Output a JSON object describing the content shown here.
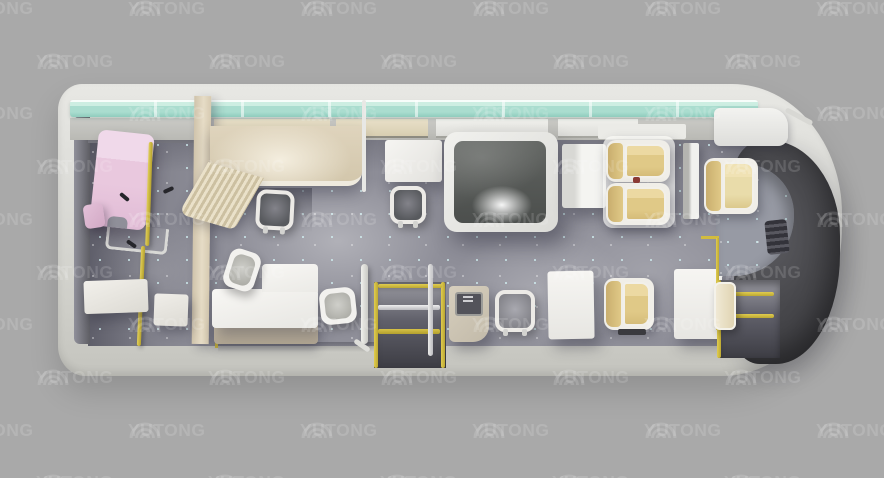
{
  "watermark": {
    "text": "YUTONG",
    "logo_icon": "yutong-arcs-logo",
    "tile_color": "rgba(255,255,255,0.14)"
  },
  "palette": {
    "background": "#a9a9a9",
    "floor": "#8f8f99",
    "glass_strip": "#aaddcf",
    "partition_beige": "#d3c7ac",
    "exam_bed_pink": "#e0bbd5",
    "seat_tan": "#e0c987",
    "seat_cream": "#e9dcaa",
    "furniture_white": "#f2f1ee",
    "handrail_yellow": "#d2bc3e",
    "front_dash_dark": "#3f3f43",
    "floor_speckle": "#bfe8ea"
  }
}
